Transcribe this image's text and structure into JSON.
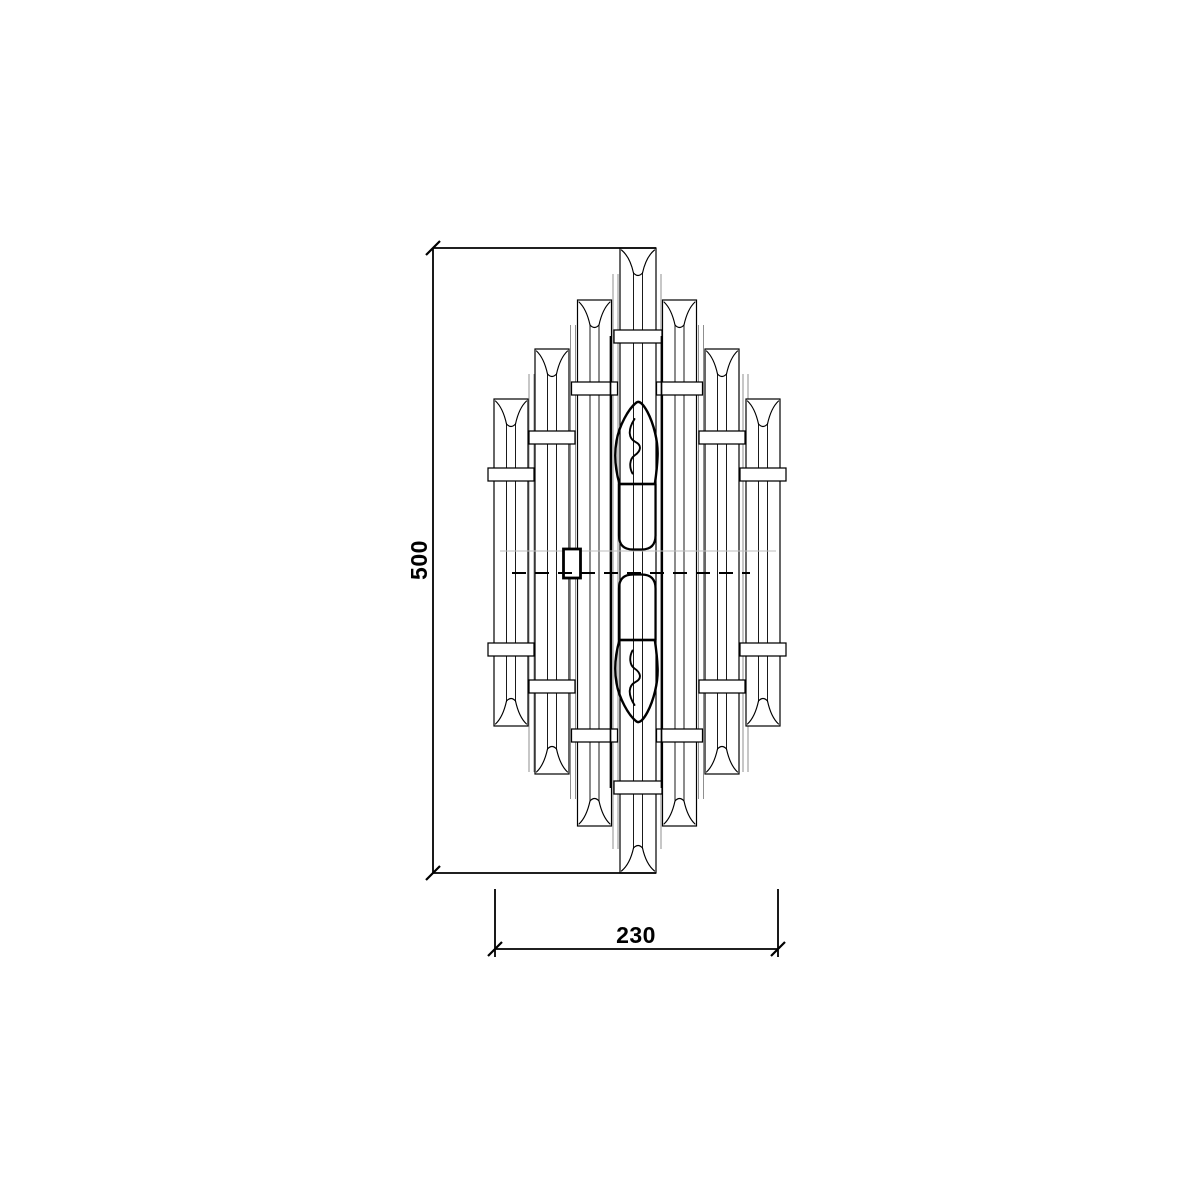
{
  "page": {
    "background": "#ffffff",
    "width": 1200,
    "height": 1200
  },
  "drawing": {
    "description": "Front elevation technical drawing of a tiered crystal rod wall sconce with two candle bulbs",
    "line_color": "#000000",
    "gray_line_color": "#8f8f8f",
    "faint_line_color": "#bdbdbd"
  },
  "dimensions": {
    "height": {
      "label": "500"
    },
    "width": {
      "label": "230"
    }
  },
  "fixture": {
    "mirror_y": 562,
    "rods": [
      {
        "tier": 0,
        "x": 620,
        "w": 36,
        "top": 248,
        "bottom": 873
      },
      {
        "tier": 1,
        "x": 577.5,
        "w": 34,
        "top": 300,
        "bottom": 826
      },
      {
        "tier": 1,
        "x": 662.5,
        "w": 34,
        "top": 300,
        "bottom": 826
      },
      {
        "tier": 2,
        "x": 535,
        "w": 34,
        "top": 349,
        "bottom": 774
      },
      {
        "tier": 2,
        "x": 705,
        "w": 34,
        "top": 349,
        "bottom": 774
      },
      {
        "tier": 3,
        "x": 494,
        "w": 34,
        "top": 399,
        "bottom": 726
      },
      {
        "tier": 3,
        "x": 746,
        "w": 34,
        "top": 399,
        "bottom": 726
      }
    ],
    "collar_top_y": [
      330,
      382,
      431,
      468
    ],
    "collar_h": 13,
    "collar_overhang": 6,
    "flare_depth": 28,
    "channel_half_gap": 4.5,
    "background_line_pairs": [
      {
        "xs": [
          529,
          534
        ],
        "top": 374,
        "bottom": 772
      },
      {
        "xs": [
          570.5,
          575.5
        ],
        "top": 325,
        "bottom": 799
      },
      {
        "xs": [
          613,
          618
        ],
        "top": 274,
        "bottom": 849
      },
      {
        "xs": [
          656,
          661
        ],
        "top": 274,
        "bottom": 849
      },
      {
        "xs": [
          698.5,
          703.5
        ],
        "top": 325,
        "bottom": 799
      },
      {
        "xs": [
          743,
          748
        ],
        "top": 374,
        "bottom": 772
      }
    ],
    "housing_lines": {
      "xs": [
        610.5,
        661.5
      ],
      "top": 336,
      "bottom": 788
    },
    "faint_line": {
      "y": 551,
      "x1": 500,
      "x2": 776
    },
    "center_axis": {
      "y": 573,
      "x1": 512,
      "x2": 750
    },
    "junction_box": {
      "x": 563.5,
      "y": 549,
      "w": 17,
      "h": 29
    }
  },
  "dim_geometry": {
    "vertical": {
      "x": 433,
      "y1": 248,
      "y2": 873,
      "ext_x2": 656
    },
    "horizontal": {
      "y": 949,
      "x1": 495,
      "x2": 778,
      "ext_y1": 889,
      "ext_y2": 957
    }
  }
}
